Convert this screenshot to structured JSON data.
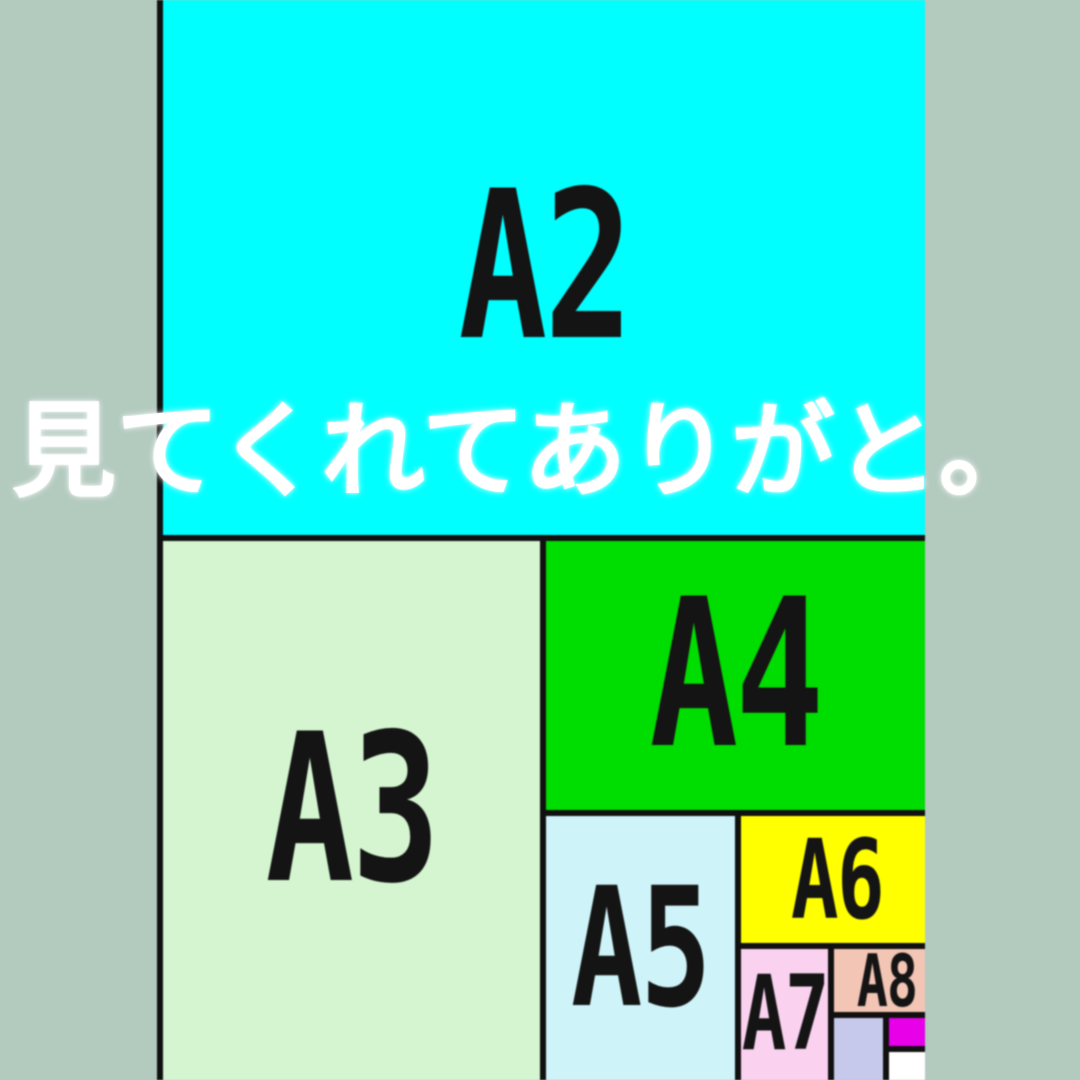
{
  "canvas": {
    "background": "#b3cabf"
  },
  "overlay": {
    "text": "見てくれてありがと。",
    "color": "#ffffff"
  },
  "diagram": {
    "border_color": "#101010",
    "label_color": "#141414",
    "boxes": [
      {
        "id": "a2",
        "label": "A2",
        "color": "#00ffff"
      },
      {
        "id": "a3",
        "label": "A3",
        "color": "#d4f5d0"
      },
      {
        "id": "a4",
        "label": "A4",
        "color": "#00dd00"
      },
      {
        "id": "a5",
        "label": "A5",
        "color": "#cef4f9"
      },
      {
        "id": "a6",
        "label": "A6",
        "color": "#ffff00"
      },
      {
        "id": "a7",
        "label": "A7",
        "color": "#fad2f0"
      },
      {
        "id": "a8",
        "label": "A8",
        "color": "#f3c5b5"
      },
      {
        "id": "a9",
        "label": "",
        "color": "#c7c9ec"
      },
      {
        "id": "a10",
        "label": "",
        "color": "#e800e8"
      },
      {
        "id": "a11",
        "label": "",
        "color": "#ffffff"
      }
    ]
  }
}
